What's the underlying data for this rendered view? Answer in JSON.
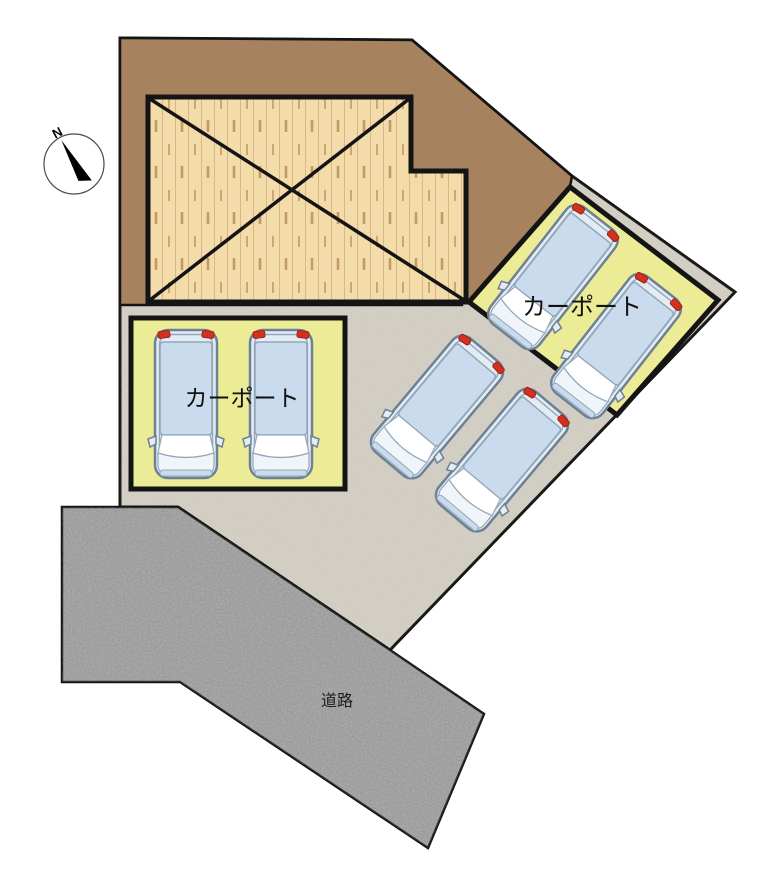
{
  "labels": {
    "north": "N",
    "carport_left": "カーポート",
    "carport_right": "カーポート",
    "road": "道路"
  },
  "compass": {
    "label": "N",
    "needle_rotation_deg": -28
  },
  "counts": {
    "cars_total": 6,
    "carports": 2
  },
  "cars": [
    {
      "x": 186,
      "y": 404,
      "angle": 0
    },
    {
      "x": 281,
      "y": 404,
      "angle": 0
    },
    {
      "x": 437,
      "y": 407,
      "angle": 40
    },
    {
      "x": 502,
      "y": 460,
      "angle": 40
    },
    {
      "x": 553,
      "y": 277,
      "angle": 38
    },
    {
      "x": 616,
      "y": 346,
      "angle": 38
    }
  ],
  "colors": {
    "outline": "#141414",
    "ground_brown": "#a6825f",
    "pavement": "#d6d2c8",
    "wood_base": "#f3dcaa",
    "wood_grain": "#d8b887",
    "wood_tick": "#c29a63",
    "carport_yellow": "#ecec96",
    "road_gray": "#b0b0b0",
    "car_body": "#e3ecf5",
    "car_glass": "#c9dbec",
    "car_outline": "#6e8094",
    "car_inner": "#93a7ba",
    "tail_light": "#d4301e",
    "hood_white": "#f0f5fa",
    "text": "#111111"
  }
}
